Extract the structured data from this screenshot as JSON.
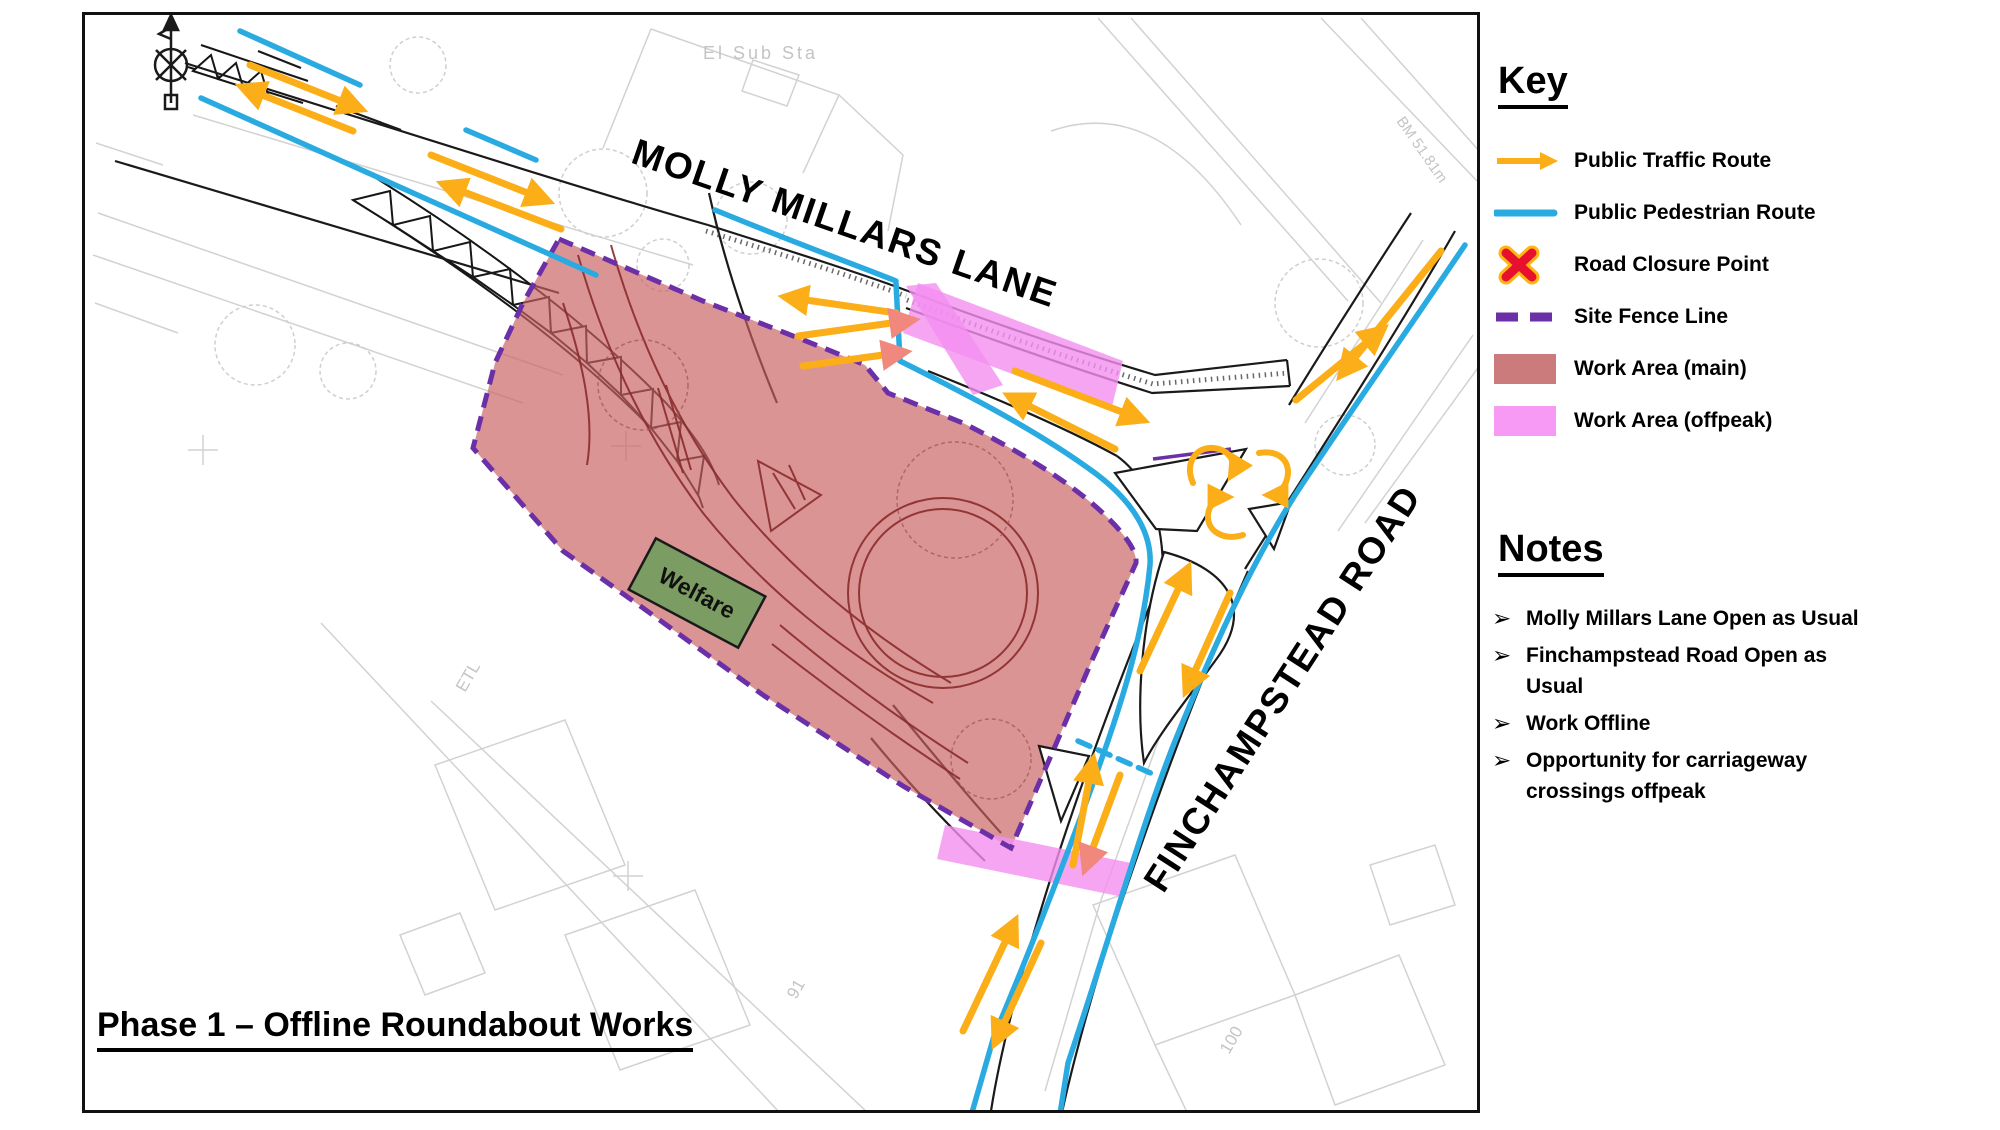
{
  "map": {
    "phase_title": "Phase 1 – Offline Roundabout Works",
    "road_labels": {
      "molly_millars": "MOLLY MILLARS LANE",
      "finchampstead": "FINCHAMPSTEAD ROAD"
    },
    "welfare_label": "Welfare",
    "base_labels": {
      "el_sub_sta": "El Sub Sta",
      "bench_mark": "BM 51.81m",
      "etl": "ETL",
      "num_91": "91",
      "num_100": "100"
    }
  },
  "key": {
    "title": "Key",
    "items": [
      {
        "label": "Public Traffic Route",
        "swatch": "traffic-arrow"
      },
      {
        "label": "Public Pedestrian Route",
        "swatch": "pedestrian-line"
      },
      {
        "label": "Road Closure Point",
        "swatch": "closure-x"
      },
      {
        "label": "Site Fence Line",
        "swatch": "fence-dashes"
      },
      {
        "label": "Work Area (main)",
        "swatch": "work-main"
      },
      {
        "label": "Work Area (offpeak)",
        "swatch": "work-offpeak"
      }
    ]
  },
  "notes": {
    "title": "Notes",
    "bullet": "➢",
    "items": [
      "Molly Millars Lane Open as Usual",
      "Finchampstead Road Open as\nUsual",
      "Work Offline",
      "Opportunity for carriageway\ncrossings offpeak"
    ]
  },
  "colors": {
    "traffic_route_yellow": "#FBAE17",
    "pedestrian_route_blue": "#29ABE2",
    "closure_red": "#E8112D",
    "closure_outline": "#FFB612",
    "site_fence_purple": "#6B2FA8",
    "work_area_main": "#C96262",
    "work_area_offpeak": "#F48FF0",
    "welfare_green": "#7B9C62",
    "crossing_arrow_salmon": "#F0887E"
  }
}
